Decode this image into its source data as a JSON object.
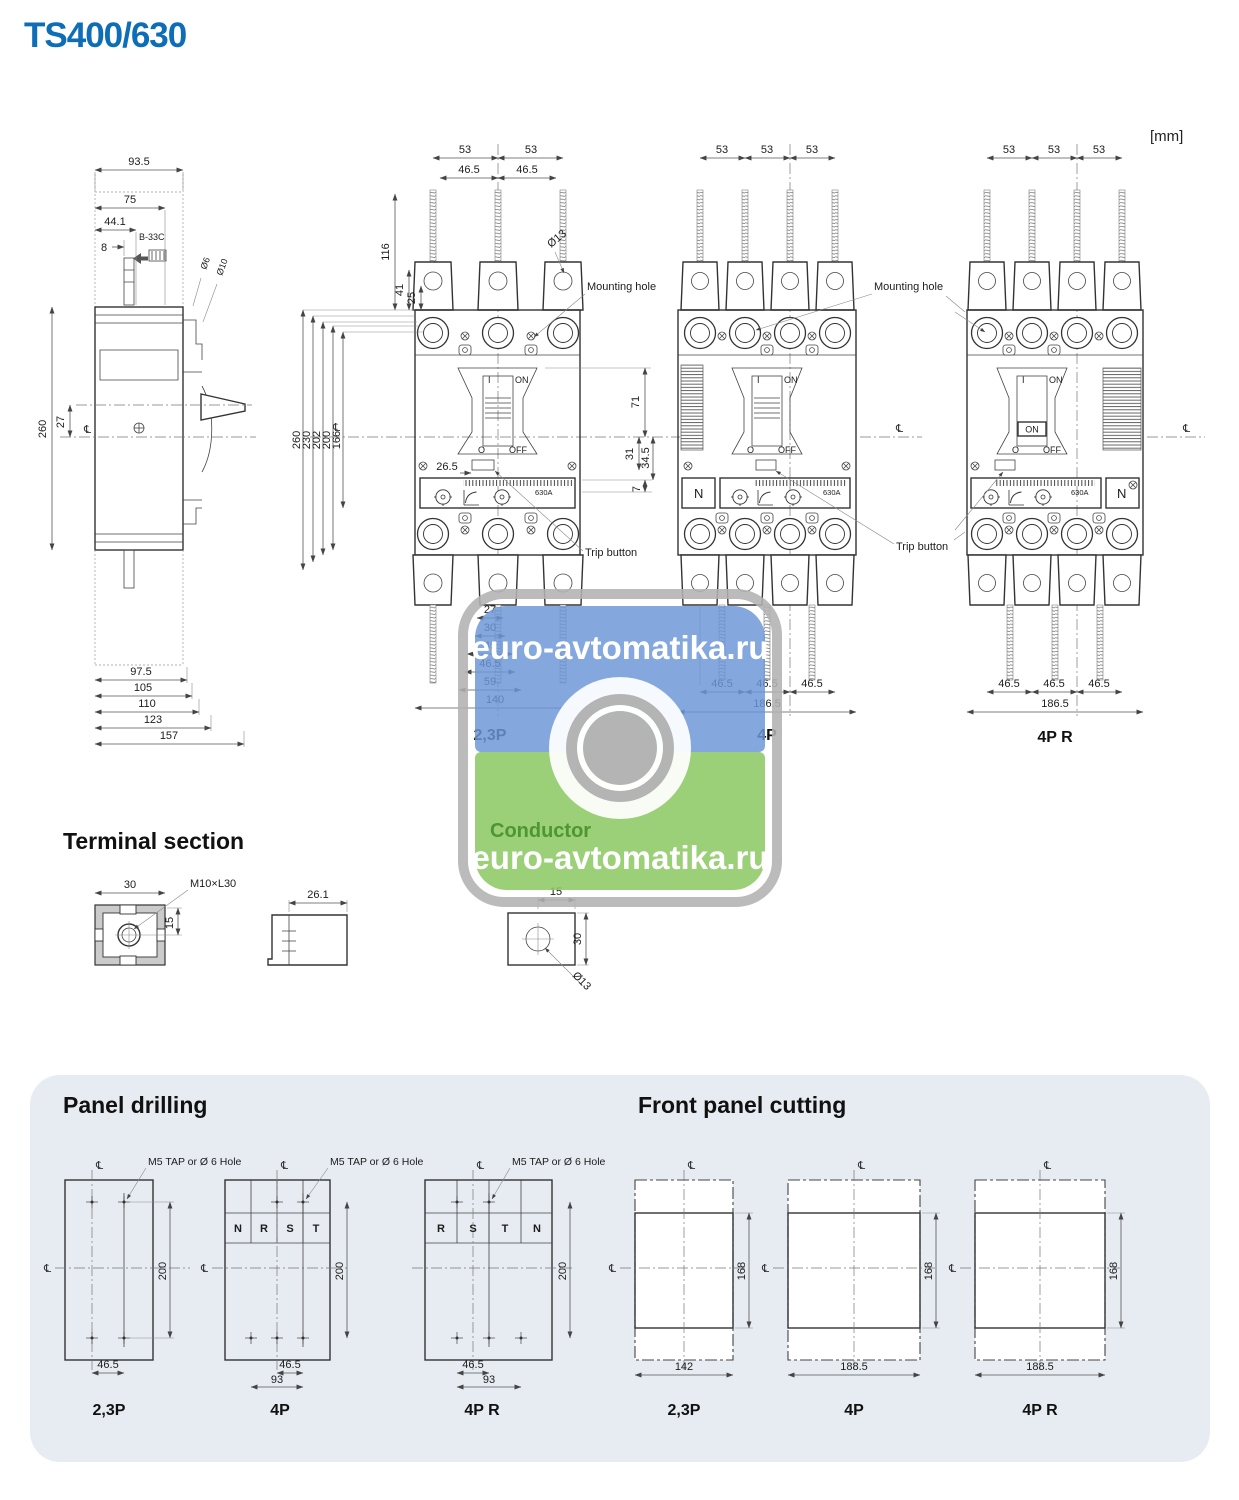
{
  "colors": {
    "accent_blue": "#0d6db6",
    "panel_bg": "#e7ecf2",
    "wm_blue": "#6c96d8",
    "wm_green": "#8bc763",
    "wm_gray": "#b2b2b2",
    "wm_brand_green": "#4d9733"
  },
  "title": "TS400/630",
  "units": "[mm]",
  "labels": {
    "mounting_hole": "Mounting hole",
    "trip_button": "Trip button",
    "on": "ON",
    "off": "OFF",
    "i": "I",
    "o": "O",
    "n": "N",
    "cl": "℄",
    "rating": "630A"
  },
  "watermark": {
    "site": "euro-avtomatika.ru",
    "brand": "Conductor"
  },
  "side_view": {
    "top_dims": [
      "93.5",
      "75",
      "44.1",
      "8"
    ],
    "accessory": "B-33C",
    "dia": [
      "Ø6",
      "Ø10"
    ],
    "height": "260",
    "center_offset": "27",
    "bottom_dims": [
      "97.5",
      "105",
      "110",
      "123",
      "157"
    ]
  },
  "front_23p": {
    "name": "2,3P",
    "top53": [
      "53",
      "53"
    ],
    "top465": [
      "46.5",
      "46.5"
    ],
    "vert": [
      "116",
      "41",
      "25"
    ],
    "dia13": "Ø13",
    "left": [
      "260",
      "230",
      "202",
      "200",
      "166"
    ],
    "right": [
      "71",
      "31",
      "34.5",
      "7"
    ],
    "trip_offset": "26.5",
    "bottom": [
      "27",
      "30",
      "45",
      "46.5",
      "59",
      "140"
    ]
  },
  "front_4p": {
    "name": "4P",
    "top": [
      "53",
      "53",
      "53"
    ],
    "bottom": [
      "46.5",
      "46.5",
      "46.5"
    ],
    "width": "186.5"
  },
  "front_4pr": {
    "name": "4P R",
    "top": [
      "53",
      "53",
      "53"
    ],
    "bottom": [
      "46.5",
      "46.5",
      "46.5"
    ],
    "width": "186.5"
  },
  "terminal": {
    "heading": "Terminal section",
    "nut_w": "30",
    "thread": "M10×L30",
    "nut_h": "15",
    "clamp_w": "26.1",
    "lug_w": "15",
    "lug_h": "30",
    "lug_dia": "Ø13"
  },
  "panel_drilling": {
    "heading": "Panel drilling",
    "callout": "M5 TAP or Ø 6 Hole",
    "h": "200",
    "w1": "46.5",
    "w2": "93",
    "phases_4p": [
      "N",
      "R",
      "S",
      "T"
    ],
    "phases_4pr": [
      "R",
      "S",
      "T",
      "N"
    ],
    "names": [
      "2,3P",
      "4P",
      "4P R"
    ]
  },
  "front_cutting": {
    "heading": "Front panel cutting",
    "h": "168",
    "widths": [
      "142",
      "188.5",
      "188.5"
    ],
    "names": [
      "2,3P",
      "4P",
      "4P R"
    ]
  }
}
